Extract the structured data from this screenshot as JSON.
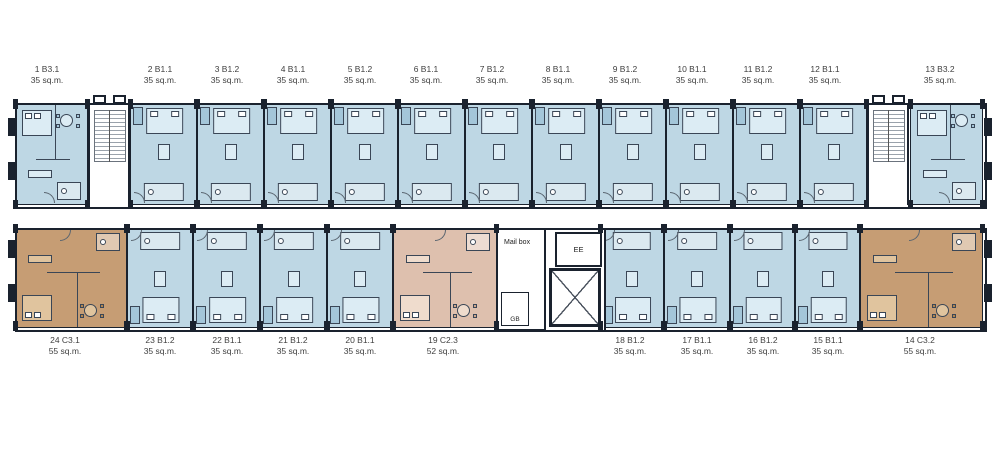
{
  "palette": {
    "wall": "#1a222e",
    "line": "#3a4656",
    "door": "#5a6570",
    "label": "#3f3f3f",
    "stair": "#9aa2ab",
    "blue": "#bed7e4",
    "blue_light": "#dcecf4",
    "blue_shade": "#a4c6d9",
    "tan": "#c69d74",
    "tan_light": "#e0c49e",
    "tan_shade": "#b2854f",
    "pink": "#dec0ae",
    "pink_light": "#efdccd",
    "pink_shade": "#d0a98f"
  },
  "core": {
    "mailbox_label": "Mail box",
    "elevator_label": "EE",
    "gb_label": "GB"
  },
  "stairwells": [
    {
      "x": 88
    },
    {
      "x": 867
    }
  ],
  "outer_columns": {
    "xs": [
      8,
      984
    ],
    "ys": [
      118,
      162,
      240,
      284
    ]
  },
  "units": [
    {
      "label": "1 B3.1",
      "area": "35 sq.m.",
      "band": "top",
      "color": "blue",
      "kind": "suite",
      "x": 15,
      "w": 73,
      "label_x": 47
    },
    {
      "label": "2 B1.1",
      "area": "35 sq.m.",
      "band": "top",
      "color": "blue",
      "kind": "std",
      "x": 130,
      "w": 67,
      "label_x": 160
    },
    {
      "label": "3 B1.2",
      "area": "35 sq.m.",
      "band": "top",
      "color": "blue",
      "kind": "std",
      "x": 197,
      "w": 67,
      "label_x": 227
    },
    {
      "label": "4 B1.1",
      "area": "35 sq.m.",
      "band": "top",
      "color": "blue",
      "kind": "std",
      "x": 264,
      "w": 67,
      "label_x": 293
    },
    {
      "label": "5 B1.2",
      "area": "35 sq.m.",
      "band": "top",
      "color": "blue",
      "kind": "std",
      "x": 331,
      "w": 67,
      "label_x": 360
    },
    {
      "label": "6 B1.1",
      "area": "35 sq.m.",
      "band": "top",
      "color": "blue",
      "kind": "std",
      "x": 398,
      "w": 67,
      "label_x": 426
    },
    {
      "label": "7 B1.2",
      "area": "35 sq.m.",
      "band": "top",
      "color": "blue",
      "kind": "std",
      "x": 465,
      "w": 67,
      "label_x": 492
    },
    {
      "label": "8 B1.1",
      "area": "35 sq.m.",
      "band": "top",
      "color": "blue",
      "kind": "std",
      "x": 532,
      "w": 67,
      "label_x": 558
    },
    {
      "label": "9 B1.2",
      "area": "35 sq.m.",
      "band": "top",
      "color": "blue",
      "kind": "std",
      "x": 599,
      "w": 67,
      "label_x": 625
    },
    {
      "label": "10 B1.1",
      "area": "35 sq.m.",
      "band": "top",
      "color": "blue",
      "kind": "std",
      "x": 666,
      "w": 67,
      "label_x": 692
    },
    {
      "label": "11 B1.2",
      "area": "35 sq.m.",
      "band": "top",
      "color": "blue",
      "kind": "std",
      "x": 733,
      "w": 67,
      "label_x": 758
    },
    {
      "label": "12 B1.1",
      "area": "35 sq.m.",
      "band": "top",
      "color": "blue",
      "kind": "std",
      "x": 800,
      "w": 67,
      "label_x": 825
    },
    {
      "label": "13 B3.2",
      "area": "35 sq.m.",
      "band": "top",
      "color": "blue",
      "kind": "suite",
      "x": 910,
      "w": 73,
      "label_x": 940
    },
    {
      "label": "14 C3.2",
      "area": "55 sq.m.",
      "band": "bottom",
      "color": "tan",
      "kind": "suite",
      "x": 860,
      "w": 123,
      "label_x": 920
    },
    {
      "label": "15 B1.1",
      "area": "35 sq.m.",
      "band": "bottom",
      "color": "blue",
      "kind": "std",
      "x": 795,
      "w": 65,
      "label_x": 828
    },
    {
      "label": "16 B1.2",
      "area": "35 sq.m.",
      "band": "bottom",
      "color": "blue",
      "kind": "std",
      "x": 730,
      "w": 65,
      "label_x": 763
    },
    {
      "label": "17 B1.1",
      "area": "35 sq.m.",
      "band": "bottom",
      "color": "blue",
      "kind": "std",
      "x": 664,
      "w": 66,
      "label_x": 697
    },
    {
      "label": "18 B1.2",
      "area": "35 sq.m.",
      "band": "bottom",
      "color": "blue",
      "kind": "std",
      "x": 600,
      "w": 64,
      "label_x": 630
    },
    {
      "label": "19 C2.3",
      "area": "52 sq.m.",
      "band": "bottom",
      "color": "pink",
      "kind": "suite",
      "x": 393,
      "w": 104,
      "label_x": 443
    },
    {
      "label": "20 B1.1",
      "area": "35 sq.m.",
      "band": "bottom",
      "color": "blue",
      "kind": "std",
      "x": 327,
      "w": 66,
      "label_x": 360
    },
    {
      "label": "21 B1.2",
      "area": "35 sq.m.",
      "band": "bottom",
      "color": "blue",
      "kind": "std",
      "x": 260,
      "w": 67,
      "label_x": 293
    },
    {
      "label": "22 B1.1",
      "area": "35 sq.m.",
      "band": "bottom",
      "color": "blue",
      "kind": "std",
      "x": 193,
      "w": 67,
      "label_x": 227
    },
    {
      "label": "23 B1.2",
      "area": "35 sq.m.",
      "band": "bottom",
      "color": "blue",
      "kind": "std",
      "x": 127,
      "w": 66,
      "label_x": 160
    },
    {
      "label": "24 C3.1",
      "area": "55 sq.m.",
      "band": "bottom",
      "color": "tan",
      "kind": "suite",
      "x": 15,
      "w": 112,
      "label_x": 65
    }
  ]
}
